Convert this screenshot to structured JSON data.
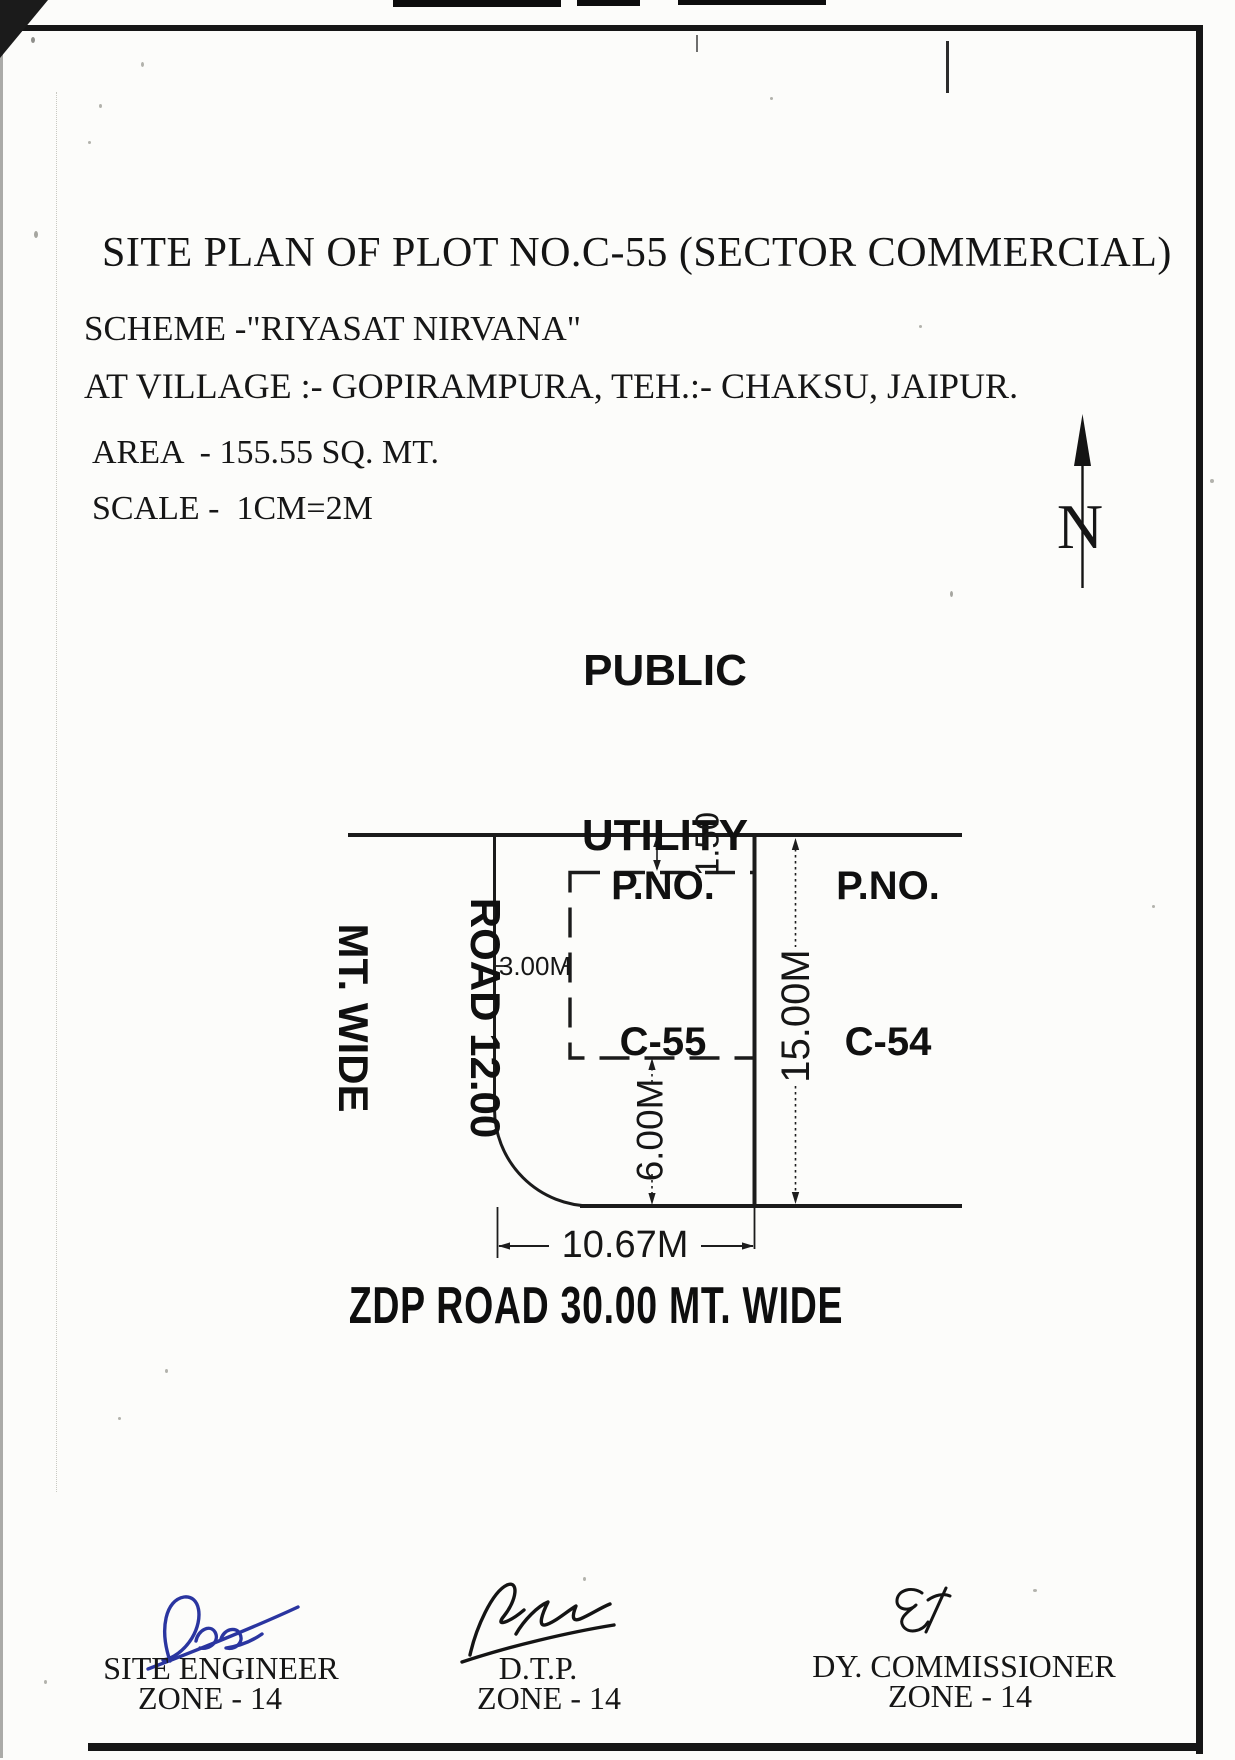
{
  "colors": {
    "ink": "#1b1b1b",
    "signature_blue": "#2a35a0"
  },
  "header": {
    "title": "SITE PLAN OF PLOT NO.C-55 (SECTOR COMMERCIAL)",
    "scheme": "SCHEME -\"RIYASAT NIRVANA\"",
    "village": "AT VILLAGE :- GOPIRAMPURA, TEH.:- CHAKSU, JAIPUR.",
    "area": "AREA  - 155.55 SQ. MT.",
    "scale": "SCALE -  1CM=2M"
  },
  "compass": {
    "label": "N"
  },
  "plan": {
    "north_area_label": {
      "line1": "PUBLIC",
      "line2": "UTILITY"
    },
    "plot_label": {
      "line1": "P.NO.",
      "line2": "C-55"
    },
    "adjacent_plot_label": {
      "line1": "P.NO.",
      "line2": "C-54"
    },
    "west_road_label": {
      "line1": "ROAD 12.00",
      "line2": "MT. WIDE"
    },
    "south_road_label": "ZDP ROAD 30.00 MT. WIDE",
    "dimensions": {
      "north_setback": "1.50",
      "west_setback": "3.00M",
      "south_setback": "6.00M",
      "depth": "15.00M",
      "frontage": "10.67M"
    }
  },
  "signatures": [
    {
      "title": "SITE ENGINEER",
      "zone": "ZONE - 14"
    },
    {
      "title": "D.T.P.",
      "zone": "ZONE - 14"
    },
    {
      "title": "DY. COMMISSIONER",
      "zone": "ZONE - 14"
    }
  ]
}
